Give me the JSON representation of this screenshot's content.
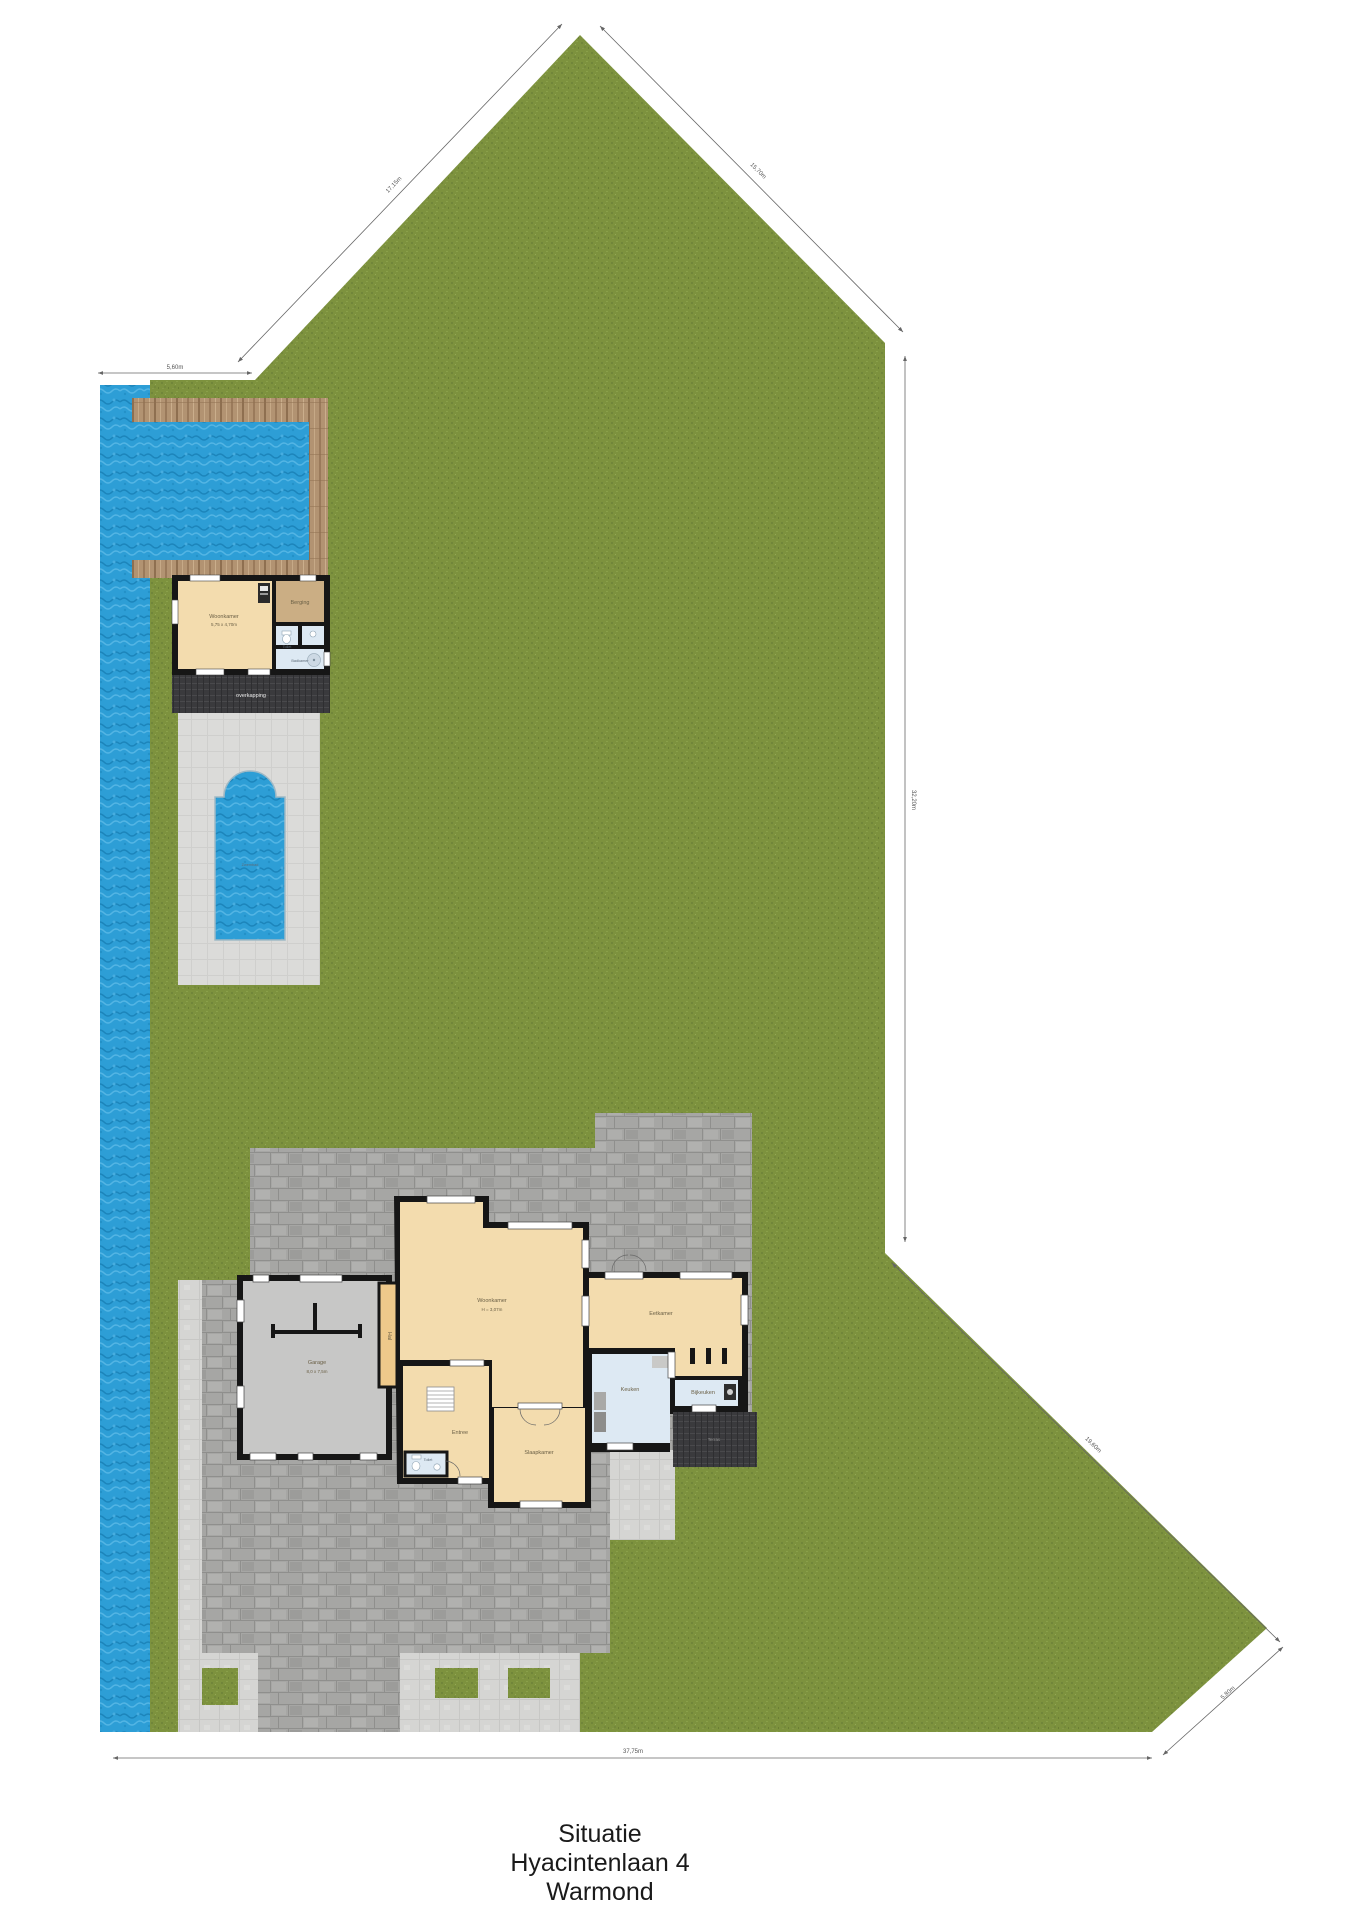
{
  "page": {
    "title_lines": [
      "Situatie",
      "Hyacintenlaan 4",
      "Warmond"
    ]
  },
  "labels": {
    "zwembad": "Zwembad",
    "overkapping": "overkapping",
    "terras": "Terras"
  },
  "rooms": {
    "house": {
      "woonkamer": {
        "label": "Woonkamer",
        "sub": "H = 3,07m"
      },
      "garage": {
        "label": "Garage",
        "sub": "8,0 x 7,5m"
      },
      "hal": {
        "label": "Hal"
      },
      "entree": {
        "label": "Entree"
      },
      "toilet": {
        "label": "Toilet"
      },
      "slaapkamer": {
        "label": "Slaapkamer"
      },
      "eetkamer": {
        "label": "Eetkamer"
      },
      "keuken": {
        "label": "Keuken"
      },
      "bijkeuken": {
        "label": "Bijkeuken"
      }
    },
    "poolhouse": {
      "woonkamer": {
        "label": "Woonkamer",
        "sub": "5,75 x 4,70m"
      },
      "berging": {
        "label": "Berging"
      },
      "toilet": {
        "label": "Toilet"
      },
      "badkamer": {
        "label": "Badkamer"
      }
    }
  },
  "dimensions": {
    "top_left": "5,60m",
    "left_diagonal": "17,15m",
    "right_diagonal": "15,70m",
    "right_side": "32,20m",
    "bottom_right_upper": "19,60m",
    "bottom_right_lower": "5,80m",
    "bottom": "37,75m"
  },
  "colors": {
    "grass": "#7d923e",
    "water": "#2d9ed6",
    "wood_deck": "#b29372",
    "brick_paving": "#a6a6a4",
    "light_paving": "#d5d5d3",
    "dark_deck": "#3a3a3d",
    "house_floor": "#f3dcae",
    "storage_floor": "#cbae84",
    "wet_room_floor": "#dde9f3",
    "garage_floor": "#c7c7c6",
    "walls": "#161616"
  }
}
